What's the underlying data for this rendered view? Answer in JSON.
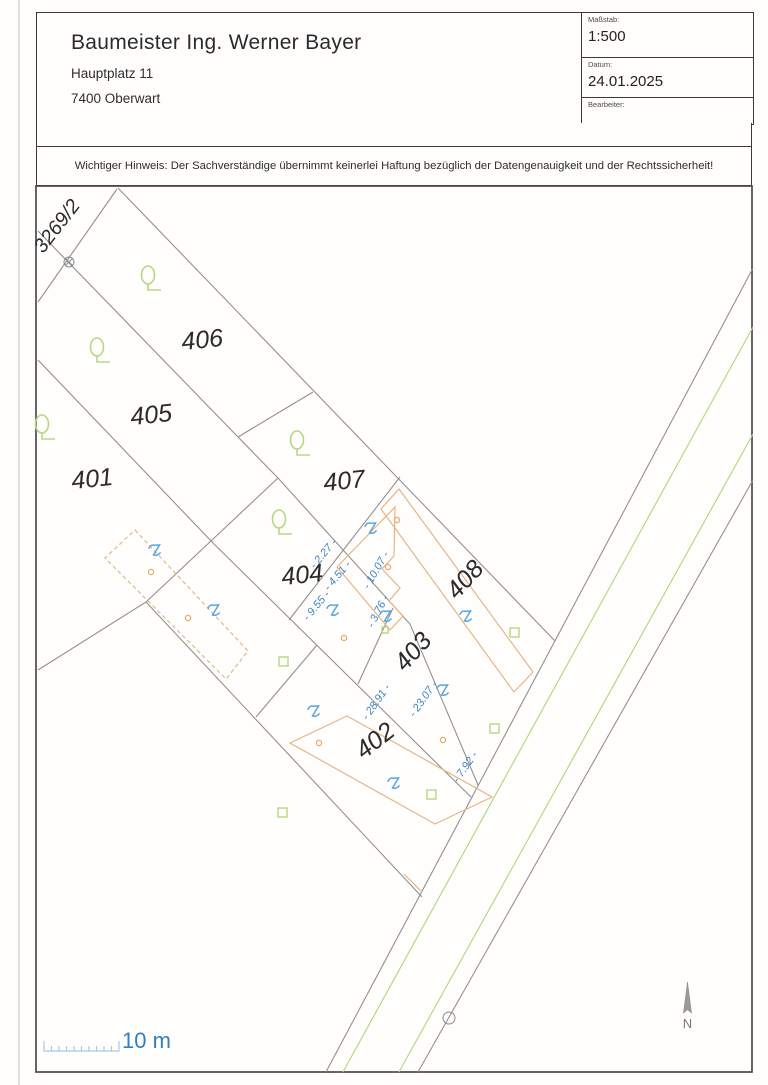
{
  "header": {
    "company": "Baumeister Ing. Werner Bayer",
    "address_line1": "Hauptplatz 11",
    "address_line2": "7400 Oberwart",
    "scale_label": "Maßstab:",
    "scale_value": "1:500",
    "date_label": "Datum:",
    "date_value": "24.01.2025",
    "editor_label": "Bearbeiter:",
    "editor_value": ""
  },
  "notice": "Wichtiger Hinweis: Der Sachverständige übernimmt keinerlei Haftung bezüglich der Datengenauigkeit und der Rechtssicherheit!",
  "plan": {
    "parcel_labels": [
      "3269/2",
      "406",
      "405",
      "401",
      "407",
      "404",
      "408",
      "403",
      "402"
    ],
    "dimension_labels": [
      "- 2.27 -",
      "- 4.51 -",
      "- 9.55 -",
      "- 10.07 -",
      "- 3.76 -",
      "- 23.07 -",
      "- 28.91 -",
      "- 7.92 -"
    ],
    "scale_bar_label": "10 m",
    "north_label": "N"
  },
  "colors": {
    "boundary_gray": "#909090",
    "border_dark": "#3a3a3a",
    "dimension_blue": "#3c85c4",
    "symbol_blue": "#5aa7e0",
    "scale_blue": "#2f7fc1",
    "vegetation_green": "#b6d884",
    "building_orange": "#e5b584",
    "label_ink": "#2b2b2b"
  }
}
